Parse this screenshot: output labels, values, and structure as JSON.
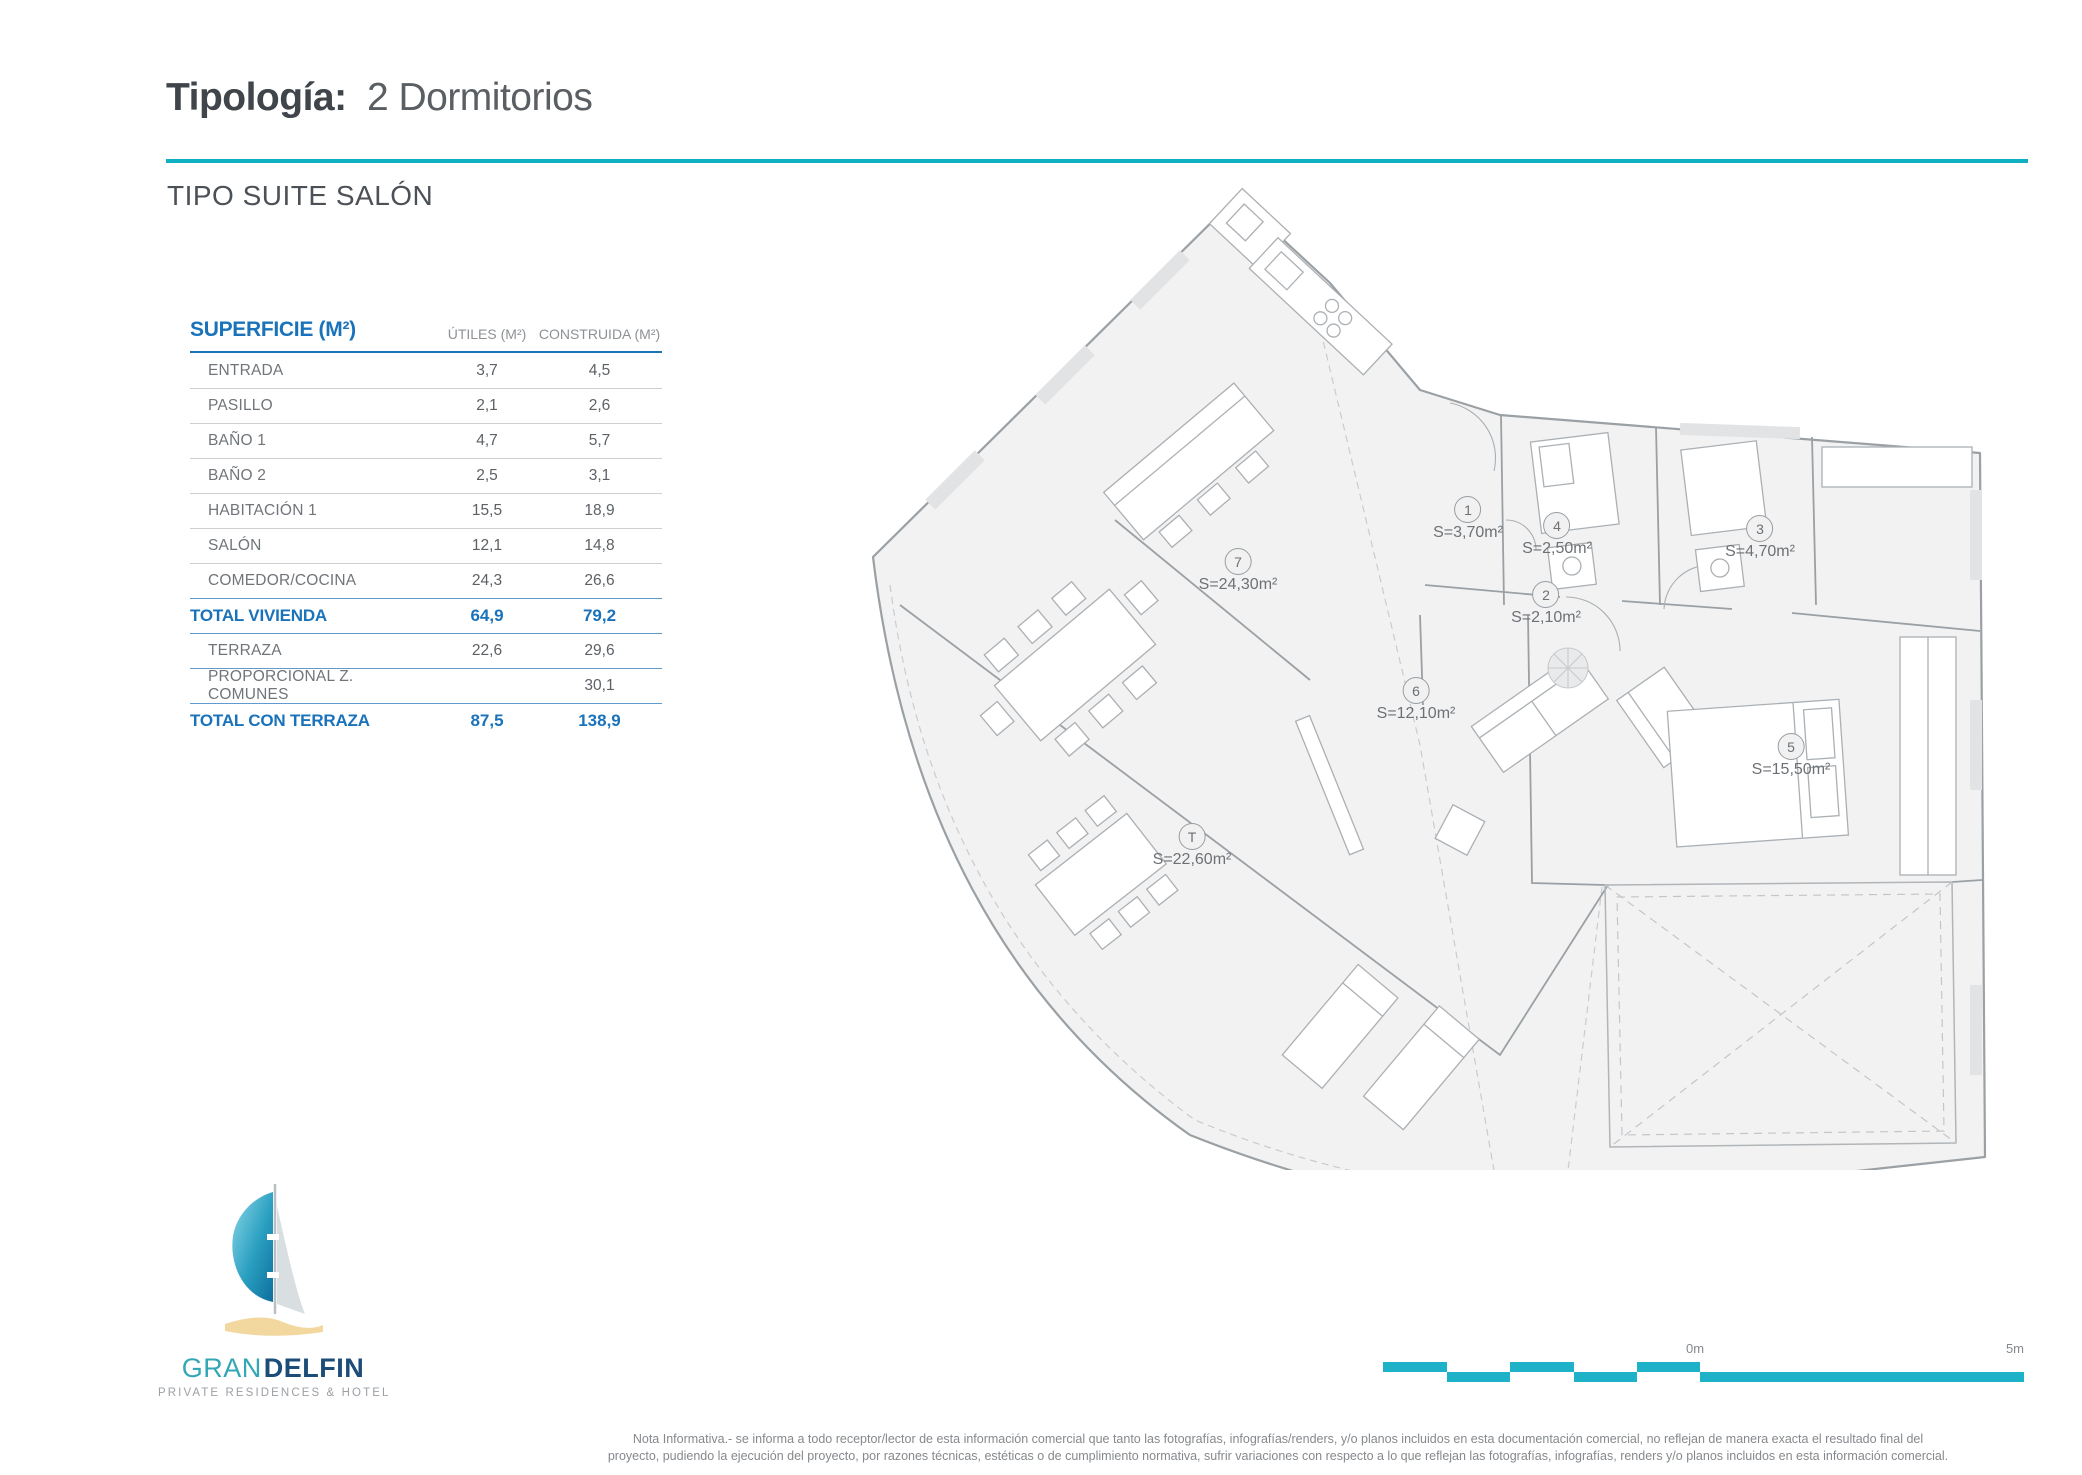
{
  "header": {
    "title_label": "Tipología:",
    "title_value": "2 Dormitorios",
    "subtitle": "TIPO SUITE SALÓN"
  },
  "table": {
    "header": {
      "col1": "SUPERFICIE (M²)",
      "col2": "ÚTILES (M²)",
      "col3": "CONSTRUIDA (M²)"
    },
    "rows": [
      {
        "label": "ENTRADA",
        "utiles": "3,7",
        "construida": "4,5"
      },
      {
        "label": "PASILLO",
        "utiles": "2,1",
        "construida": "2,6"
      },
      {
        "label": "BAÑO 1",
        "utiles": "4,7",
        "construida": "5,7"
      },
      {
        "label": "BAÑO 2",
        "utiles": "2,5",
        "construida": "3,1"
      },
      {
        "label": "HABITACIÓN 1",
        "utiles": "15,5",
        "construida": "18,9"
      },
      {
        "label": "SALÓN",
        "utiles": "12,1",
        "construida": "14,8"
      },
      {
        "label": "COMEDOR/COCINA",
        "utiles": "24,3",
        "construida": "26,6"
      },
      {
        "label": "TOTAL VIVIENDA",
        "utiles": "64,9",
        "construida": "79,2"
      },
      {
        "label": "TERRAZA",
        "utiles": "22,6",
        "construida": "29,6"
      },
      {
        "label": "PROPORCIONAL Z. COMUNES",
        "utiles": "",
        "construida": "30,1"
      },
      {
        "label": "TOTAL CON TERRAZA",
        "utiles": "87,5",
        "construida": "138,9"
      }
    ]
  },
  "floorplan": {
    "labels": [
      {
        "num": "1",
        "area": "S=3,70m²"
      },
      {
        "num": "2",
        "area": "S=2,10m²"
      },
      {
        "num": "3",
        "area": "S=4,70m²"
      },
      {
        "num": "4",
        "area": "S=2,50m²"
      },
      {
        "num": "5",
        "area": "S=15,50m²"
      },
      {
        "num": "6",
        "area": "S=12,10m²"
      },
      {
        "num": "7",
        "area": "S=24,30m²"
      },
      {
        "num": "T",
        "area": "S=22,60m²"
      }
    ],
    "scale": {
      "zero": "0m",
      "five": "5m"
    }
  },
  "logo": {
    "gran": "GRAN",
    "delfin": "DELFIN",
    "tagline": "PRIVATE RESIDENCES & HOTEL"
  },
  "disclaimer": {
    "line1": "Nota Informativa.- se informa a todo receptor/lector de esta información comercial que tanto las fotografías, infografías/renders, y/o planos incluidos en esta documentación comercial, no reflejan de manera exacta el resultado final del",
    "line2": "proyecto, pudiendo la ejecución del proyecto, por razones técnicas, estéticas o de cumplimiento normativa, sufrir variaciones con respecto a lo que reflejan las fotografías, infografías, renders y/o planos incluidos en esta información comercial."
  },
  "colors": {
    "teal_rule": "#10b0c2",
    "table_blue": "#1a73ba",
    "scalebar_teal": "#1db2c7",
    "logo_teal": "#33a7b5",
    "logo_navy": "#1c4d78"
  }
}
